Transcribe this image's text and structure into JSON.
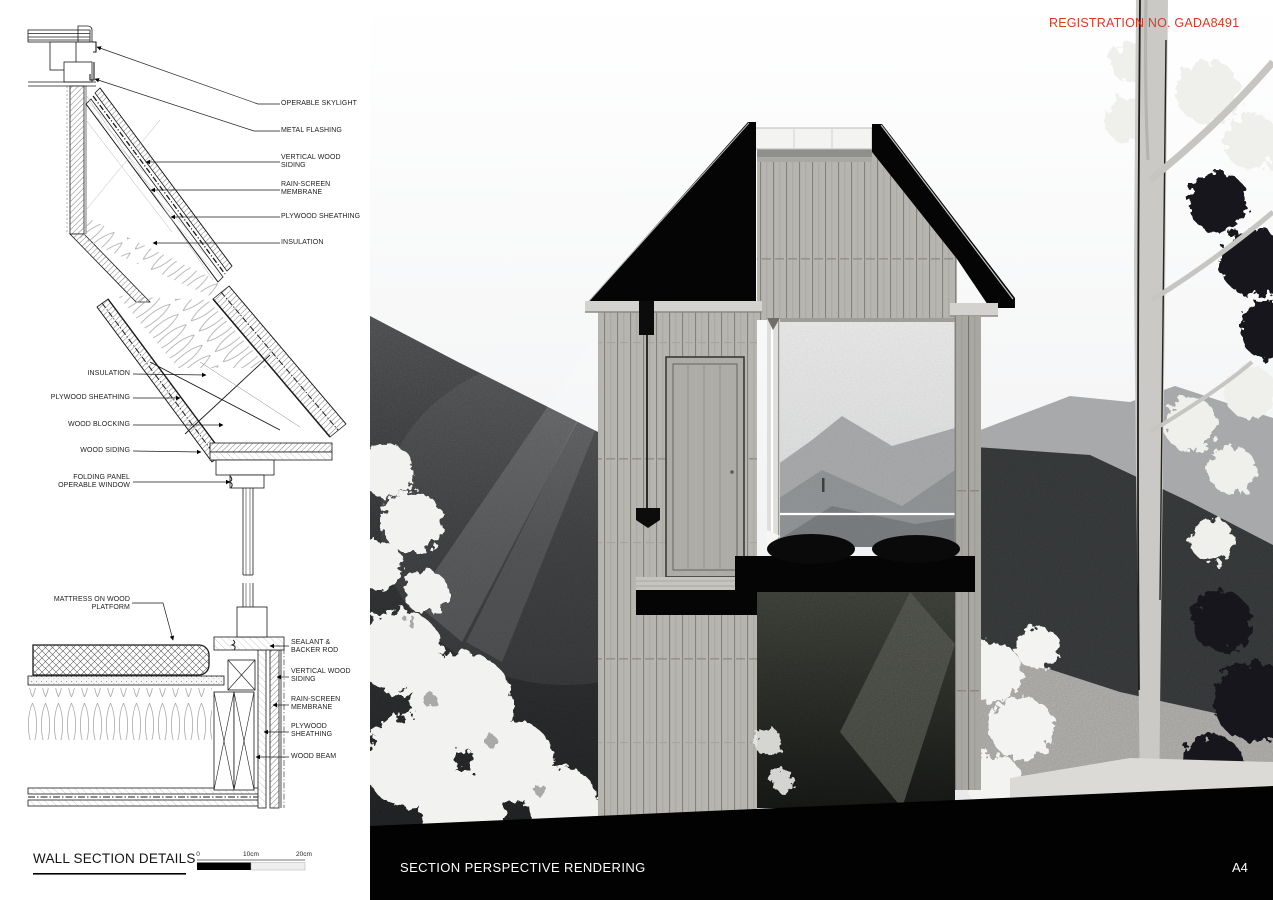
{
  "registration": {
    "text": "REGISTRATION NO. GADA8491",
    "color": "#dd3a20"
  },
  "footer": {
    "details_title": "WALL SECTION DETAILS",
    "rendering_title": "SECTION PERSPECTIVE RENDERING",
    "sheet_number": "A4",
    "scale_ticks": [
      "0",
      "10cm",
      "20cm"
    ]
  },
  "details": [
    {
      "labels": [
        "OPERABLE SKYLIGHT",
        "METAL FLASHING",
        "VERTICAL WOOD SIDING",
        "RAIN-SCREEN MEMBRANE",
        "PLYWOOD SHEATHING",
        "INSULATION"
      ]
    },
    {
      "labels": [
        "INSULATION",
        "PLYWOOD SHEATHING",
        "WOOD BLOCKING",
        "WOOD SIDING",
        "FOLDING PANEL OPERABLE WINDOW"
      ]
    },
    {
      "labels": [
        "MATTRESS ON WOOD PLATFORM",
        "SEALANT & BACKER ROD",
        "VERTICAL WOOD SIDING",
        "RAIN-SCREEN MEMBRANE",
        "PLYWOOD SHEATHING",
        "WOOD BEAM"
      ]
    }
  ]
}
